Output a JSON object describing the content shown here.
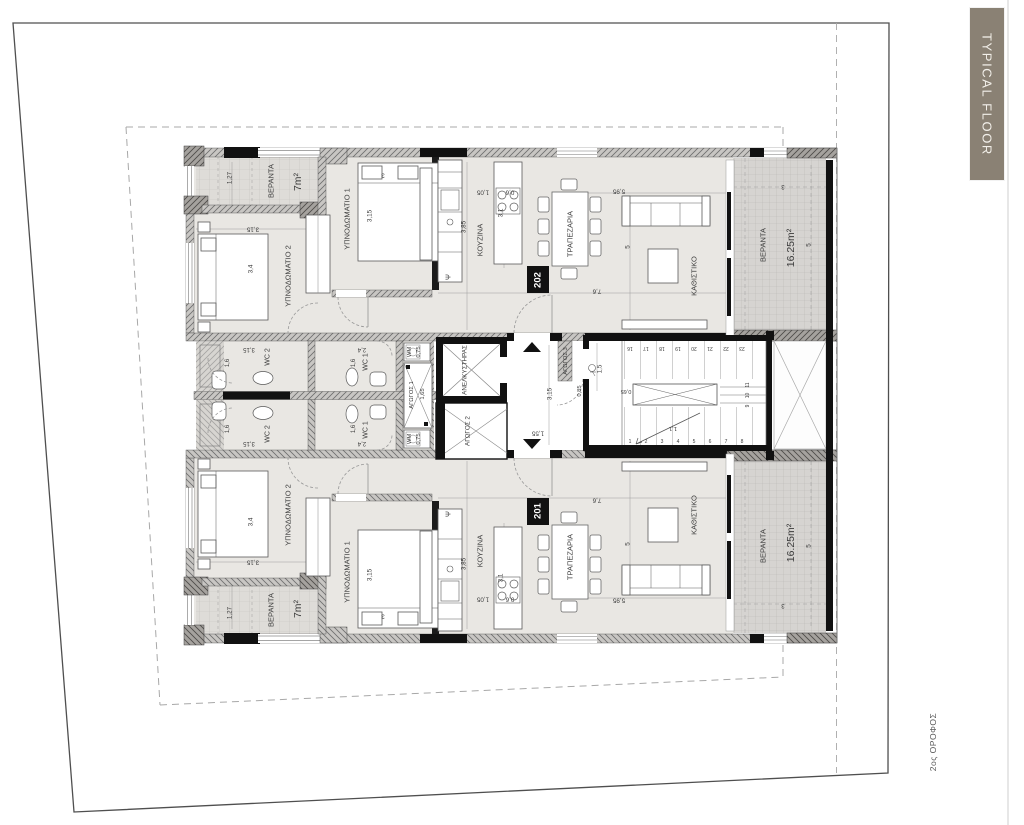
{
  "banner": {
    "label": "TYPICAL FLOOR",
    "bg": "#8a8174",
    "text_color": "#f2efe9"
  },
  "floor_note": "2ος ΟΡΟΦΟΣ",
  "colors": {
    "unit_box": "#111111",
    "label": "#3c3c3c",
    "wall_dark": "#111111",
    "veranda_fill": "#d6d4d1",
    "room_fill": "#e9e7e3"
  },
  "units": [
    {
      "number": "202",
      "rooms": [
        "ΥΠΝΟΔΩΜΑΤΙΟ 1",
        "ΥΠΝΟΔΩΜΑΤΙΟ 2",
        "ΚΟΥΖΙΝΑ",
        "ΤΡΑΠΕΖΑΡΙΑ",
        "ΚΑΘΙΣΤΙΚΟ",
        "WC 1",
        "WC 2",
        "ΒΕΡΑΝΤΑ 7m²",
        "ΒΕΡΑΝΤΑ 16.25m²"
      ]
    },
    {
      "number": "201",
      "rooms": [
        "ΥΠΝΟΔΩΜΑΤΙΟ 1",
        "ΥΠΝΟΔΩΜΑΤΙΟ 2",
        "ΚΟΥΖΙΝΑ",
        "ΤΡΑΠΕΖΑΡΙΑ",
        "ΚΑΘΙΣΤΙΚΟ",
        "WC 1",
        "WC 2",
        "ΒΕΡΑΝΤΑ 7m²",
        "ΒΕΡΑΝΤΑ 16.25m²"
      ]
    }
  ],
  "core": [
    "ΑΝΕΛΚΥΣΤΗΡΑΣ",
    "ΑΓΩΓΟΣ 1",
    "ΑΓΩΓΟΣ 2",
    "ΑΓΩΓΟΣ 3",
    "WM"
  ],
  "plan_labels": [
    {
      "id": "apt202-veranda-left-label",
      "t": "ΒΕΡΑΝΤΑ",
      "x": 271,
      "y": 181,
      "r": -90,
      "s": 7.5
    },
    {
      "id": "apt202-veranda-left-area",
      "t": "7m²",
      "x": 298,
      "y": 182,
      "r": -90,
      "s": 10.5
    },
    {
      "id": "dim",
      "t": "1,27",
      "x": 230,
      "y": 178,
      "r": -90,
      "s": 6.3
    },
    {
      "id": "dim",
      "t": "3,15",
      "x": 253,
      "y": 229,
      "r": 180,
      "s": 6.3
    },
    {
      "id": "dim",
      "t": "3,4",
      "x": 251,
      "y": 269,
      "r": -90,
      "s": 6.3
    },
    {
      "id": "apt202-bedroom2-label",
      "t": "ΥΠΝΟΔΩΜΑΤΙΟ 2",
      "x": 288,
      "y": 276,
      "r": -90,
      "s": 7.5
    },
    {
      "id": "apt202-bedroom1-label",
      "t": "ΥΠΝΟΔΩΜΑΤΙΟ 1",
      "x": 347,
      "y": 219,
      "r": -90,
      "s": 7.5
    },
    {
      "id": "dim",
      "t": "3,15",
      "x": 370,
      "y": 216,
      "r": -90,
      "s": 6.3
    },
    {
      "id": "dim",
      "t": "3",
      "x": 383,
      "y": 175,
      "r": 180,
      "s": 6.3
    },
    {
      "id": "apt202-kitchen-label",
      "t": "ΚΟΥΖΙΝΑ",
      "x": 480,
      "y": 240,
      "r": -90,
      "s": 7.5
    },
    {
      "id": "dim",
      "t": "3,85",
      "x": 464,
      "y": 227,
      "r": -90,
      "s": 6.3
    },
    {
      "id": "dim",
      "t": "3,1",
      "x": 501,
      "y": 213,
      "r": -90,
      "s": 6.3
    },
    {
      "id": "dim",
      "t": "1,05",
      "x": 483,
      "y": 192,
      "r": 180,
      "s": 6.3
    },
    {
      "id": "dim",
      "t": "0,6",
      "x": 510,
      "y": 192,
      "r": 180,
      "s": 6.3
    },
    {
      "id": "kitchen-sink-psi",
      "t": "Ψ",
      "x": 449,
      "y": 277,
      "r": -90,
      "s": 7
    },
    {
      "id": "apt202-dining-label",
      "t": "ΤΡΑΠΕΖΑΡΙΑ",
      "x": 570,
      "y": 234,
      "r": -90,
      "s": 7.5
    },
    {
      "id": "dim",
      "t": "5,95",
      "x": 619,
      "y": 191,
      "r": 180,
      "s": 6.3
    },
    {
      "id": "dim",
      "t": "5",
      "x": 628,
      "y": 247,
      "r": -90,
      "s": 6.3
    },
    {
      "id": "dim",
      "t": "7,6",
      "x": 597,
      "y": 291,
      "r": 180,
      "s": 6.3
    },
    {
      "id": "apt202-living-label",
      "t": "ΚΑΘΙΣΤΙΚΟ",
      "x": 694,
      "y": 276,
      "r": -90,
      "s": 7.5
    },
    {
      "id": "apt202-number",
      "t": "202",
      "x": 538,
      "y": 280,
      "r": -90,
      "s": 9.5,
      "w": "bold",
      "c": "#ffffff"
    },
    {
      "id": "apt202-veranda-right-label",
      "t": "ΒΕΡΑΝΤΑ",
      "x": 763,
      "y": 245,
      "r": -90,
      "s": 7.5
    },
    {
      "id": "apt202-veranda-right-area",
      "t": "16.25m²",
      "x": 791,
      "y": 248,
      "r": -90,
      "s": 10.5
    },
    {
      "id": "dim",
      "t": "3",
      "x": 783,
      "y": 186,
      "r": 180,
      "s": 6
    },
    {
      "id": "dim",
      "t": "5",
      "x": 809,
      "y": 245,
      "r": -90,
      "s": 6.3
    },
    {
      "id": "apt202-wc2-label",
      "t": "WC 2",
      "x": 268,
      "y": 357,
      "r": -90,
      "s": 7
    },
    {
      "id": "dim",
      "t": "3,15",
      "x": 249,
      "y": 349,
      "r": 180,
      "s": 6
    },
    {
      "id": "dim",
      "t": "1,6",
      "x": 228,
      "y": 363,
      "r": -90,
      "s": 6
    },
    {
      "id": "apt202-wc1-label",
      "t": "WC 1",
      "x": 366,
      "y": 362,
      "r": -90,
      "s": 7
    },
    {
      "id": "dim",
      "t": "2,4",
      "x": 362,
      "y": 349,
      "r": 180,
      "s": 6
    },
    {
      "id": "dim",
      "t": "1,6",
      "x": 354,
      "y": 363,
      "r": -90,
      "s": 6
    },
    {
      "id": "apt202-wm-label",
      "t": "WM",
      "x": 410,
      "y": 352,
      "r": -90,
      "s": 5.8
    },
    {
      "id": "dim",
      "t": "0,75",
      "x": 419,
      "y": 352,
      "r": -90,
      "s": 5.8
    },
    {
      "id": "duct1-label",
      "t": "ΑΓΩΓΟΣ 1",
      "x": 412,
      "y": 395,
      "r": -90,
      "s": 5.8
    },
    {
      "id": "dim",
      "t": "1,65",
      "x": 423,
      "y": 394,
      "r": -90,
      "s": 5.8
    },
    {
      "id": "elevator-label",
      "t": "ΑΝΕΛΚΥΣΤΗΡΑΣ",
      "x": 465,
      "y": 370,
      "r": -90,
      "s": 6.3
    },
    {
      "id": "duct2-label",
      "t": "ΑΓΩΓΟΣ 2",
      "x": 468,
      "y": 431,
      "r": -90,
      "s": 6.3
    },
    {
      "id": "duct3-label",
      "t": "ΑΓΩΓΟΣ 3",
      "x": 566,
      "y": 361,
      "r": -90,
      "s": 5.8
    },
    {
      "id": "dim",
      "t": "0,85",
      "x": 580,
      "y": 391,
      "r": -90,
      "s": 5.8
    },
    {
      "id": "dim",
      "t": "3,15",
      "x": 550,
      "y": 394,
      "r": -90,
      "s": 6.3
    },
    {
      "id": "dim",
      "t": "1,55",
      "x": 538,
      "y": 433,
      "r": 180,
      "s": 6.3
    },
    {
      "id": "dim",
      "t": "1,5",
      "x": 600,
      "y": 369,
      "r": -90,
      "s": 6.3
    },
    {
      "id": "dim",
      "t": "0,65",
      "x": 626,
      "y": 391,
      "r": 180,
      "s": 5.5
    },
    {
      "id": "dim",
      "t": "1,1",
      "x": 673,
      "y": 428,
      "r": 180,
      "s": 5.8
    },
    {
      "id": "stair-step",
      "t": "16",
      "x": 630,
      "y": 348,
      "r": 180,
      "s": 5
    },
    {
      "id": "stair-step",
      "t": "17",
      "x": 646,
      "y": 348,
      "r": 180,
      "s": 5
    },
    {
      "id": "stair-step",
      "t": "18",
      "x": 662,
      "y": 348,
      "r": 180,
      "s": 5
    },
    {
      "id": "stair-step",
      "t": "19",
      "x": 678,
      "y": 348,
      "r": 180,
      "s": 5
    },
    {
      "id": "stair-step",
      "t": "20",
      "x": 694,
      "y": 348,
      "r": 180,
      "s": 5
    },
    {
      "id": "stair-step",
      "t": "21",
      "x": 710,
      "y": 348,
      "r": 180,
      "s": 5
    },
    {
      "id": "stair-step",
      "t": "22",
      "x": 726,
      "y": 348,
      "r": 180,
      "s": 5
    },
    {
      "id": "stair-step",
      "t": "23",
      "x": 742,
      "y": 348,
      "r": 180,
      "s": 5
    },
    {
      "id": "stair-step",
      "t": "1",
      "x": 630,
      "y": 442,
      "r": 0,
      "s": 5
    },
    {
      "id": "stair-step",
      "t": "2",
      "x": 646,
      "y": 442,
      "r": 0,
      "s": 5
    },
    {
      "id": "stair-step",
      "t": "3",
      "x": 662,
      "y": 442,
      "r": 0,
      "s": 5
    },
    {
      "id": "stair-step",
      "t": "4",
      "x": 678,
      "y": 442,
      "r": 0,
      "s": 5
    },
    {
      "id": "stair-step",
      "t": "5",
      "x": 694,
      "y": 442,
      "r": 0,
      "s": 5
    },
    {
      "id": "stair-step",
      "t": "6",
      "x": 710,
      "y": 442,
      "r": 0,
      "s": 5
    },
    {
      "id": "stair-step",
      "t": "7",
      "x": 726,
      "y": 442,
      "r": 0,
      "s": 5
    },
    {
      "id": "stair-step",
      "t": "8",
      "x": 742,
      "y": 442,
      "r": 0,
      "s": 5
    },
    {
      "id": "stair-step",
      "t": "11",
      "x": 748,
      "y": 385,
      "r": -90,
      "s": 5
    },
    {
      "id": "stair-step",
      "t": "10",
      "x": 748,
      "y": 395.5,
      "r": -90,
      "s": 5
    },
    {
      "id": "stair-step",
      "t": "9",
      "x": 748,
      "y": 406,
      "r": -90,
      "s": 5
    },
    {
      "id": "apt201-wc2-label",
      "t": "WC 2",
      "x": 268,
      "y": 434,
      "r": -90,
      "s": 7
    },
    {
      "id": "dim",
      "t": "3,15",
      "x": 249,
      "y": 443,
      "r": 180,
      "s": 6
    },
    {
      "id": "dim",
      "t": "1,6",
      "x": 228,
      "y": 429,
      "r": -90,
      "s": 6
    },
    {
      "id": "apt201-wc1-label",
      "t": "WC 1",
      "x": 366,
      "y": 430,
      "r": -90,
      "s": 7
    },
    {
      "id": "dim",
      "t": "2,4",
      "x": 362,
      "y": 443,
      "r": 180,
      "s": 6
    },
    {
      "id": "dim",
      "t": "1,6",
      "x": 354,
      "y": 429,
      "r": -90,
      "s": 6
    },
    {
      "id": "apt201-wm-label",
      "t": "WM",
      "x": 410,
      "y": 439,
      "r": -90,
      "s": 5.8
    },
    {
      "id": "dim",
      "t": "0,75",
      "x": 419,
      "y": 439,
      "r": -90,
      "s": 5.8
    },
    {
      "id": "apt201-veranda-left-label",
      "t": "ΒΕΡΑΝΤΑ",
      "x": 271,
      "y": 610,
      "r": -90,
      "s": 7.5
    },
    {
      "id": "apt201-veranda-left-area",
      "t": "7m²",
      "x": 298,
      "y": 609,
      "r": -90,
      "s": 10.5
    },
    {
      "id": "dim",
      "t": "1,27",
      "x": 230,
      "y": 613,
      "r": -90,
      "s": 6.3
    },
    {
      "id": "dim",
      "t": "3,15",
      "x": 253,
      "y": 562,
      "r": 180,
      "s": 6.3
    },
    {
      "id": "dim",
      "t": "3,4",
      "x": 251,
      "y": 522,
      "r": -90,
      "s": 6.3
    },
    {
      "id": "apt201-bedroom2-label",
      "t": "ΥΠΝΟΔΩΜΑΤΙΟ 2",
      "x": 288,
      "y": 515,
      "r": -90,
      "s": 7.5
    },
    {
      "id": "apt201-bedroom1-label",
      "t": "ΥΠΝΟΔΩΜΑΤΙΟ 1",
      "x": 347,
      "y": 572,
      "r": -90,
      "s": 7.5
    },
    {
      "id": "dim",
      "t": "3,15",
      "x": 370,
      "y": 575,
      "r": -90,
      "s": 6.3
    },
    {
      "id": "dim",
      "t": "3",
      "x": 383,
      "y": 616,
      "r": 180,
      "s": 6.3
    },
    {
      "id": "apt201-kitchen-label",
      "t": "ΚΟΥΖΙΝΑ",
      "x": 480,
      "y": 551,
      "r": -90,
      "s": 7.5
    },
    {
      "id": "dim",
      "t": "3,85",
      "x": 464,
      "y": 564,
      "r": -90,
      "s": 6.3
    },
    {
      "id": "dim",
      "t": "3,1",
      "x": 501,
      "y": 578,
      "r": -90,
      "s": 6.3
    },
    {
      "id": "dim",
      "t": "1,05",
      "x": 483,
      "y": 599,
      "r": 180,
      "s": 6.3
    },
    {
      "id": "dim",
      "t": "0,6",
      "x": 510,
      "y": 599,
      "r": 180,
      "s": 6.3
    },
    {
      "id": "kitchen-sink-psi",
      "t": "Ψ",
      "x": 449,
      "y": 514,
      "r": -90,
      "s": 7
    },
    {
      "id": "apt201-dining-label",
      "t": "ΤΡΑΠΕΖΑΡΙΑ",
      "x": 570,
      "y": 557,
      "r": -90,
      "s": 7.5
    },
    {
      "id": "dim",
      "t": "5,95",
      "x": 619,
      "y": 600,
      "r": 180,
      "s": 6.3
    },
    {
      "id": "dim",
      "t": "5",
      "x": 628,
      "y": 544,
      "r": -90,
      "s": 6.3
    },
    {
      "id": "dim",
      "t": "7,6",
      "x": 597,
      "y": 500,
      "r": 180,
      "s": 6.3
    },
    {
      "id": "apt201-living-label",
      "t": "ΚΑΘΙΣΤΙΚΟ",
      "x": 694,
      "y": 515,
      "r": -90,
      "s": 7.5
    },
    {
      "id": "apt201-number",
      "t": "201",
      "x": 538,
      "y": 511,
      "r": -90,
      "s": 9.5,
      "w": "bold",
      "c": "#ffffff"
    },
    {
      "id": "apt201-veranda-right-label",
      "t": "ΒΕΡΑΝΤΑ",
      "x": 763,
      "y": 546,
      "r": -90,
      "s": 7.5
    },
    {
      "id": "apt201-veranda-right-area",
      "t": "16.25m²",
      "x": 791,
      "y": 543,
      "r": -90,
      "s": 10.5
    },
    {
      "id": "dim",
      "t": "3",
      "x": 783,
      "y": 605,
      "r": 180,
      "s": 6
    },
    {
      "id": "dim",
      "t": "5",
      "x": 809,
      "y": 546,
      "r": -90,
      "s": 6.3
    }
  ]
}
